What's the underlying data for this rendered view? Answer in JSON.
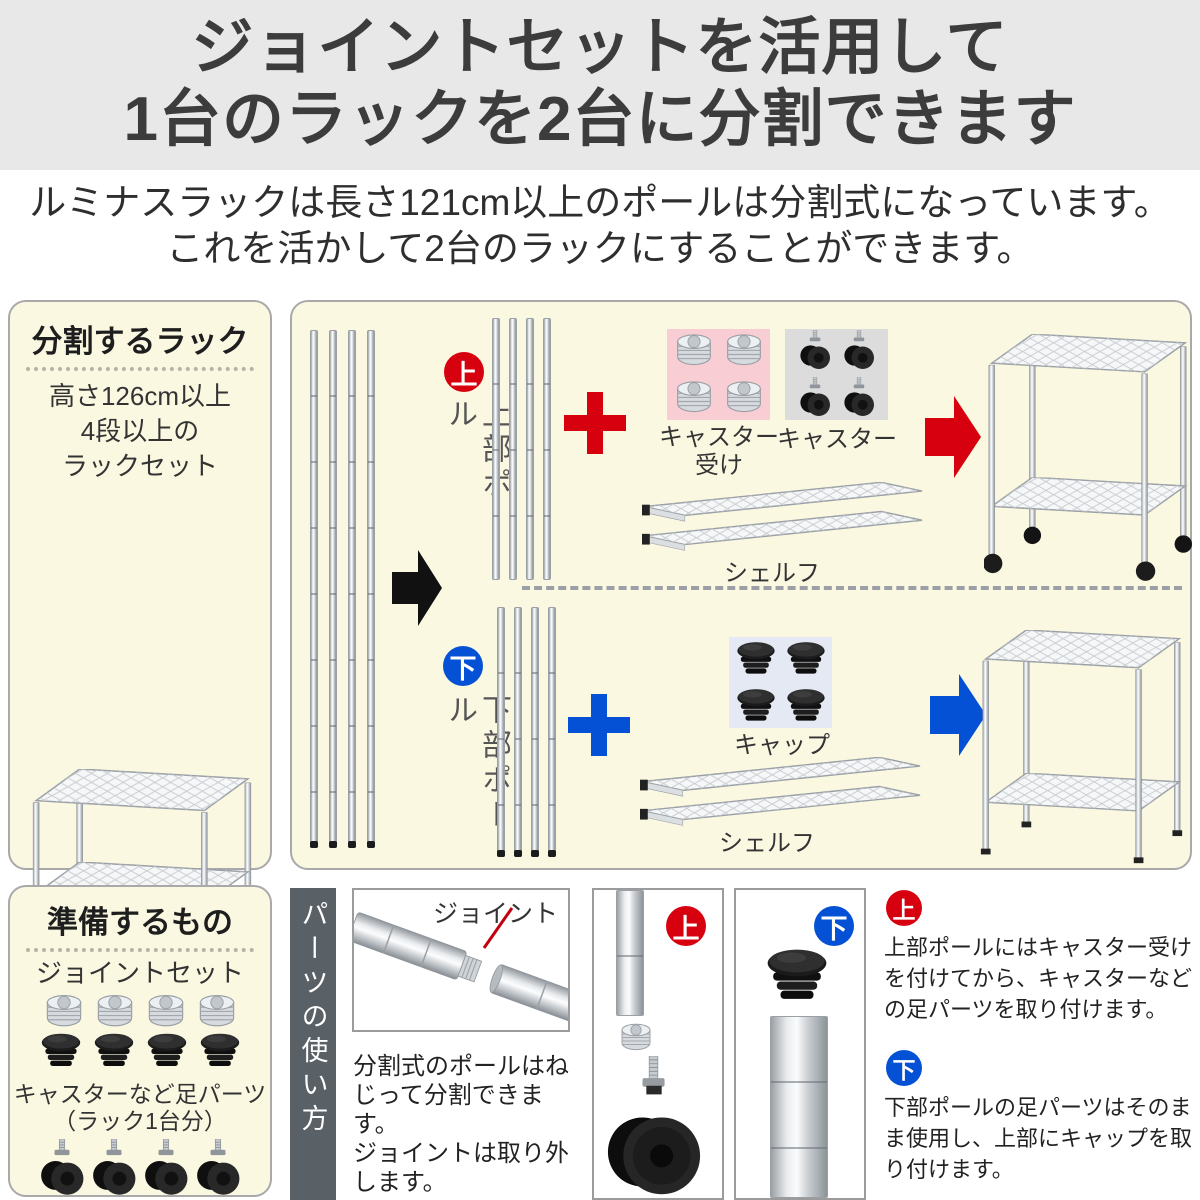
{
  "colors": {
    "header_bg": "#e8e8e8",
    "panel_cream": "#fbf8e2",
    "accent_red": "#d7000f",
    "accent_blue": "#0551d5",
    "receiver_box_pink": "#f8cdd4",
    "caster_box_gray": "#dcdcdc",
    "cap_box_blue": "#e4e9f3",
    "banner_gray": "#596066"
  },
  "header": {
    "line1": "ジョイントセットを活用して",
    "line2": "1台のラックを2台に分割できます"
  },
  "intro": {
    "line1": "ルミナスラックは長さ121cm以上のポールは分割式になっています。",
    "line2": "これを活かして2台のラックにすることができます。"
  },
  "split_rack": {
    "title": "分割するラック",
    "desc_line1": "高さ126cm以上",
    "desc_line2": "4段以上の",
    "desc_line3": "ラックセット"
  },
  "process": {
    "upper": {
      "badge": "上",
      "pole_label": "上部ポール",
      "receiver_label": "キャスター受け",
      "caster_label": "キャスター",
      "shelf_label": "シェルフ"
    },
    "lower": {
      "badge": "下",
      "pole_label": "下部ポール",
      "cap_label": "キャップ",
      "shelf_label": "シェルフ"
    }
  },
  "prepare": {
    "title": "準備するもの",
    "joint_set_label": "ジョイントセット",
    "foot_label_line1": "キャスターなど足パーツ",
    "foot_label_line2": "（ラック1台分）"
  },
  "usage": {
    "banner": "パーツの使い方",
    "joint_callout": "ジョイント",
    "split_desc_line1": "分割式のポールはね",
    "split_desc_line2": "じって分割できます。",
    "split_desc_line3": "ジョイントは取り外",
    "split_desc_line4": "します。",
    "upper_badge": "上",
    "upper_desc_line1": "上部ポールにはキャスター受け",
    "upper_desc_line2": "を付けてから、キャスターなど",
    "upper_desc_line3": "の足パーツを取り付けます。",
    "lower_badge": "下",
    "lower_desc_line1": "下部ポールの足パーツはそのま",
    "lower_desc_line2": "ま使用し、上部にキャップを取",
    "lower_desc_line3": "り付けます。"
  }
}
